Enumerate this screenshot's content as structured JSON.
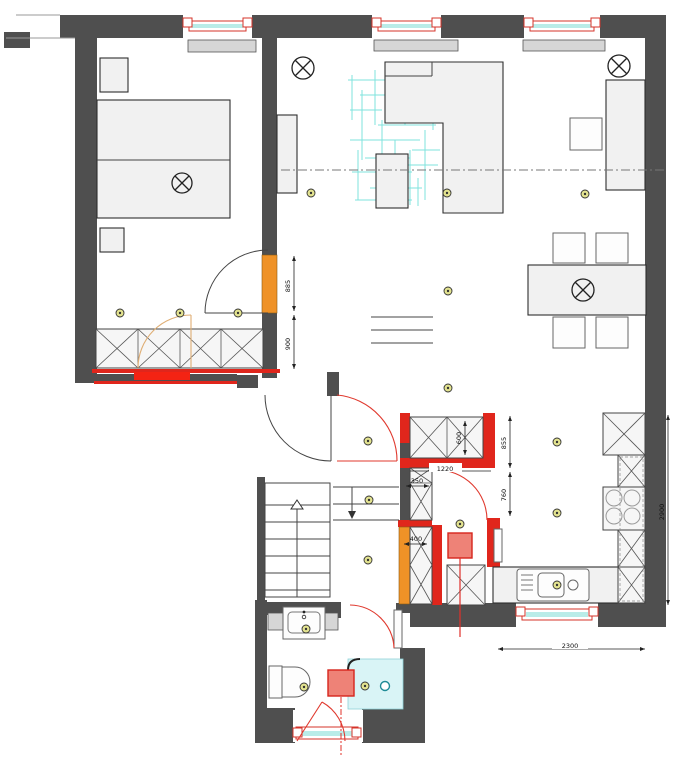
{
  "drawing": {
    "type": "apartment-floor-plan",
    "dimensions_mm": {
      "bedroom_door_opening": "885",
      "bedroom_wall_segment": "900",
      "closet_depth": "600",
      "closet_width": "1220",
      "small_closet_width": "350",
      "closet_side_wall": "855",
      "kitchen_door_opening": "760",
      "lower_closet_width": "400",
      "kitchen_window_wall": "2300",
      "kitchen_side_wall": "2900"
    },
    "colors": {
      "wall_gray": "#4f4f4f",
      "new_wall_red": "#e0261c",
      "door_orange": "#ef9227",
      "window_glass_cyan": "#b9ece8",
      "rug_hatch_cyan": "#7fe3de",
      "lamp_yellow": "#f3f0a2",
      "spotlight_yellow": "#e3e390",
      "appliance_red": "#ee8277",
      "bathroom_floor_cyan": "#d9f4f6",
      "furniture_fill": "#f1f1f1"
    },
    "icons": {
      "ceiling_lamp": "circle-with-x",
      "spotlight": "small-circle-with-x-and-dot",
      "stairs_up_arrow": "open-triangle-arrow",
      "steps_down_arrow": "filled-triangle-arrow",
      "shower_drain": "small-double-circle"
    }
  }
}
